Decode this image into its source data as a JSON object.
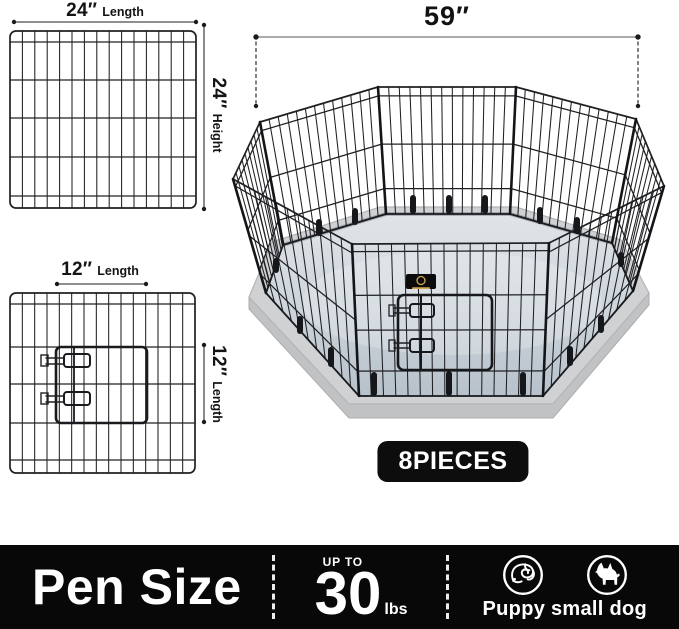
{
  "product": {
    "pen_width_label": "59″",
    "pieces_badge": "8PIECES",
    "panel_24": {
      "length_value": "24″",
      "length_word": "Length",
      "height_value": "24″",
      "height_word": "Height"
    },
    "panel_12": {
      "length_value": "12″",
      "length_word": "Length",
      "side_value": "12″",
      "side_word": "Length"
    }
  },
  "bottom_bar": {
    "title": "Pen Size",
    "weight_prefix": "UP TO",
    "weight_value": "30",
    "weight_unit": "lbs",
    "pets_label": "Puppy small dog"
  },
  "icons": [
    "puppy-icon",
    "small-dog-icon"
  ],
  "colors": {
    "wire": "#1f2023",
    "floor_light": "#e0e4e8",
    "floor_dark": "#b7c1cb",
    "slab": "#cfd1d3",
    "bar_bg": "#080808",
    "badge_bg": "#0d0d0d",
    "logo_gold": "#d2a74f"
  }
}
